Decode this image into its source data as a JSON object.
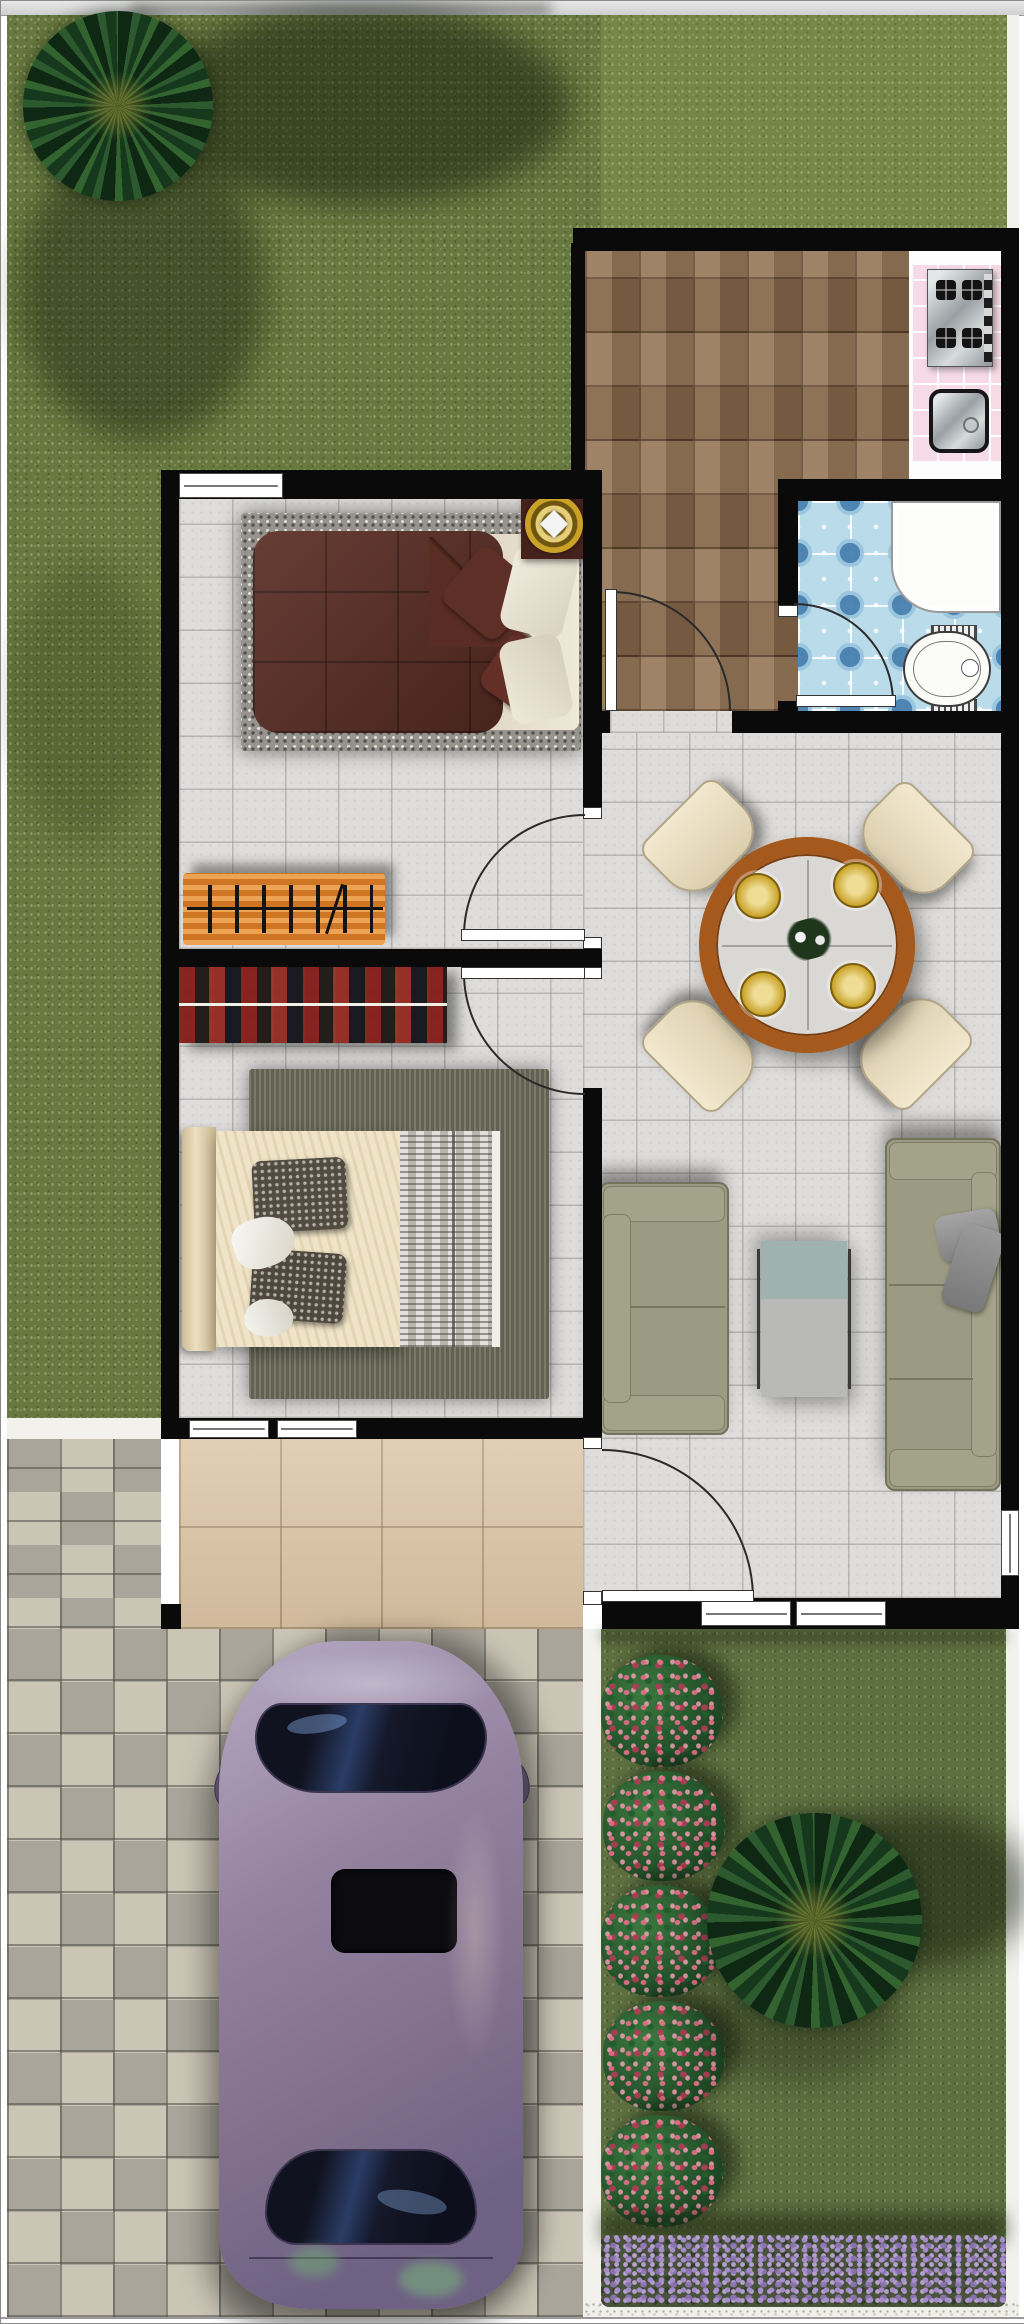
{
  "scene": {
    "type": "residential-floor-plan",
    "view": "top-down",
    "label": "Single-story house floor plan with front lawn, garden, driveway and parked car",
    "text_content": "none (image contains no text)"
  },
  "palette": {
    "lawn_grass": "#68793f",
    "garden_grass": "#5e7040",
    "wall": "#0a0a0a",
    "interior_tile": "#dedddb",
    "kitchen_tile": "#8a6d51",
    "bathroom_tile": "#badbe9",
    "counter_tile": "#f6dbe7",
    "porch_tile": "#dcc5a6",
    "paver_light": "#cbc5b6",
    "paver_dark": "#a9a59a",
    "bed1_quilt": "#5a2d24",
    "bench_orange": "#e2862c",
    "tartan_red": "#8c2420",
    "sofa_olive": "#9b9b83",
    "table_wood": "#a5591c",
    "chair_cream": "#eae0c4",
    "car_body": "#8f7f9e",
    "rose_pink": "#c44d64",
    "lavender_purple": "#a98fd0",
    "gold_decor": "#c9a227"
  },
  "outdoor": {
    "lawn": {
      "label": "Front lawn (top and left)"
    },
    "palm_top_left": {
      "label": "Palm tree on front lawn"
    },
    "palm_garden": {
      "label": "Palm tree in side garden"
    },
    "rose_bushes": {
      "label": "Row of rose bushes",
      "count": 5
    },
    "lavender_hedge": {
      "label": "Lavender flower hedge along bottom of garden"
    },
    "gravel_path": {
      "label": "White gravel border strip"
    },
    "driveway": {
      "label": "Checkered paver driveway"
    },
    "porch": {
      "label": "Entry porch with beige tiles"
    },
    "car": {
      "label": "Purple sedan parked on driveway",
      "features": [
        "windshield",
        "sunroof",
        "rear window",
        "side mirrors"
      ]
    }
  },
  "rooms": {
    "kitchen": {
      "label": "Kitchen",
      "floor": "brown stone tile",
      "fixtures": [
        "4-burner stove",
        "pink tiled counter",
        "square steel sink"
      ]
    },
    "bathroom": {
      "label": "Bathroom",
      "floor": "blue patterned mosaic tile",
      "fixtures": [
        "shower tray",
        "toilet"
      ]
    },
    "bedroom1": {
      "label": "Bedroom 1 (top)",
      "furniture": [
        "double bed with maroon quilt and cream pillows",
        "speckled gray rug",
        "nightstand with round gold ornament",
        "orange console bench"
      ]
    },
    "bedroom2": {
      "label": "Bedroom 2 (bottom)",
      "furniture": [
        "double bed with cream bedding, two dark pillows, gray patterned blanket",
        "dark olive rug",
        "red striped shelf unit"
      ]
    },
    "dining": {
      "label": "Dining area",
      "furniture": [
        "round wooden-rim table",
        "4 cream chairs",
        "4 gold place settings",
        "centerpiece"
      ]
    },
    "living": {
      "label": "Living area",
      "furniture": [
        "two-seat olive sofa",
        "three-seat olive sofa",
        "coffee table with glass end",
        "2 gray cushions"
      ]
    }
  },
  "openings": {
    "doors": [
      {
        "label": "Bedroom 1 door (swings into bedroom 1)"
      },
      {
        "label": "Bedroom 2 door (swings into bedroom 2)"
      },
      {
        "label": "Kitchen door (swings into kitchen)"
      },
      {
        "label": "Bathroom door (swings into bathroom)"
      },
      {
        "label": "Front entry door (porch to living area)"
      }
    ],
    "windows": [
      {
        "label": "Bedroom 1 window, north wall"
      },
      {
        "label": "Bedroom 2 windows, south wall",
        "count": 2
      },
      {
        "label": "Living area windows, south wall",
        "count": 2
      },
      {
        "label": "Living area window, east wall"
      }
    ]
  }
}
